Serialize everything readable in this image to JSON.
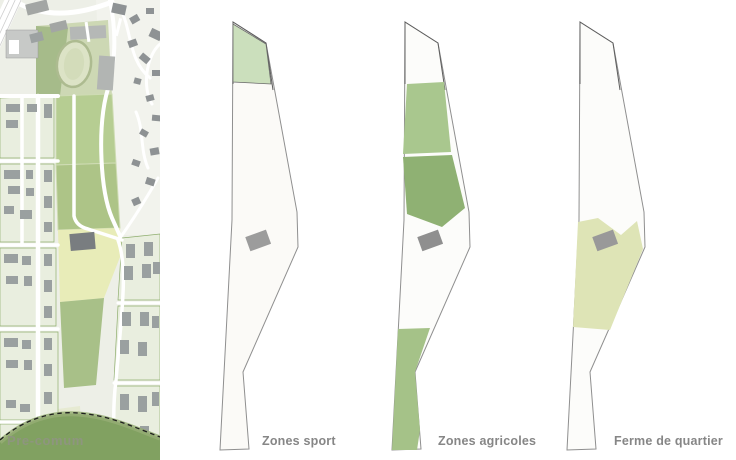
{
  "map": {
    "label": "Pre-comum",
    "palette": {
      "background": "#edefe7",
      "field_green": "#b6cd92",
      "park_green": "#cdd8b4",
      "dark_green_band": "#81a161",
      "yellow_field": "#e8ecb8",
      "building_gray": "#9aa0a0",
      "road_white": "#ffffff"
    }
  },
  "diagrams": [
    {
      "id": "zones-sport",
      "label": "Zones sport",
      "zone_colors": [
        "#cbdfbc"
      ]
    },
    {
      "id": "zones-agricoles",
      "label": "Zones agricoles",
      "zone_colors": [
        "#a9c78e",
        "#8fb173",
        "#a5c288"
      ]
    },
    {
      "id": "ferme-de-quartier",
      "label": "Ferme de quartier",
      "zone_colors": [
        "#dee4b6"
      ]
    }
  ],
  "building_color": "#979797",
  "outline_color": "#8f8f8f",
  "label_color": "#868686"
}
